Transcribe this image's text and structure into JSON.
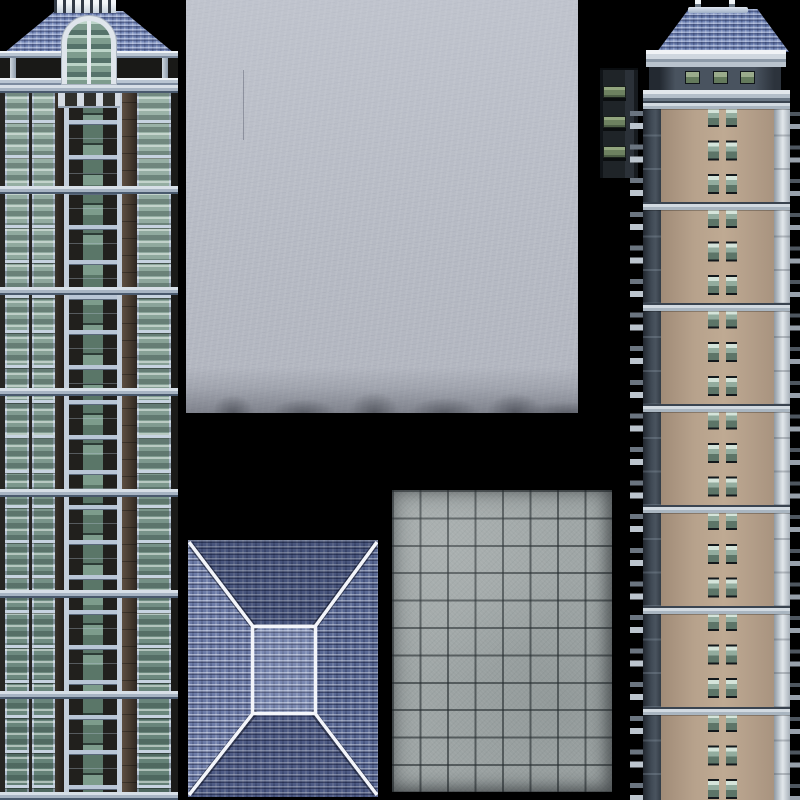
{
  "atlas": {
    "title": "Residential building texture atlas",
    "image_type": "3d-building-texture-atlas",
    "background_color": "#000000",
    "sprites": [
      {
        "id": "left-tower-facade",
        "label": "Residential glass-balcony tower facade (left column)",
        "bbox": "0,0 178x800",
        "features": {
          "crown_balustrade": true,
          "hip_roof": true,
          "arched_window": true,
          "pergola_beams": 2,
          "glass_columns": 4,
          "balcony_floors": 20,
          "major_floor_bands": 6
        },
        "palette": {
          "facade_dark": "#272624",
          "frame_light": "#b3c1d2",
          "glass_green": "#7d998d",
          "roof_blue": "#7487b6",
          "band_light": "#d7dfe7",
          "wood_brown": "#43382e"
        }
      },
      {
        "id": "stucco-wall-texture",
        "label": "Weathered stucco / concrete wall texture",
        "bbox": "186,0 392x413",
        "features": {
          "grime_bottom_edge": true,
          "hairline_cracks": 1
        },
        "palette": {
          "base": "#b9bdc6",
          "highlight": "#cbcfd9",
          "grime": "#4b4e58"
        }
      },
      {
        "id": "window-strip",
        "label": "Dark service core strip with 3 green window bars",
        "bbox": "600,68 38x110",
        "features": {
          "window_count": 3
        },
        "palette": {
          "panel_dark": "#1f2428",
          "panel_edge": "#2b3138",
          "glass_green": "#6d8160"
        }
      },
      {
        "id": "right-tower-facade",
        "label": "Tan high-rise facade with hip roof (right column)",
        "bbox": "630,0 170x800",
        "features": {
          "finials": 2,
          "hip_roof": true,
          "penthouse_windows": 3,
          "window_rows": 21,
          "windows_per_row": 2,
          "major_floor_bands": 6,
          "side_bracket_tabs": true
        },
        "palette": {
          "facade_tan": "#b7a28c",
          "facade_shadow": "#7e6e60",
          "roof_blue": "#6d81b2",
          "cornice_light": "#e3e8ed",
          "edge_dark": "#3f4954",
          "edge_light": "#cdd4da",
          "glass_green": "#93ac9e"
        }
      },
      {
        "id": "hip-roof-top-view",
        "label": "Blue shingle hip roof seen from above with white ridge lines",
        "bbox": "188,540 190x257",
        "features": {
          "ridge_lines": 4,
          "flat_top_rect": "253,627 62x86",
          "shingle_pattern": true
        },
        "palette": {
          "shingle_blue": "#5f6f9e",
          "shingle_dark": "#3d4a72",
          "ridge_white": "#f3f5fa",
          "top_rect_light": "#93a3c8"
        }
      },
      {
        "id": "concrete-tile-floor",
        "label": "Square concrete paving tile grid texture",
        "bbox": "392,490 220x302",
        "features": {
          "grid_columns": 8,
          "grid_rows": 11,
          "tile_size_px": 27
        },
        "palette": {
          "tile_gray": "#9fa6a6",
          "grout_dark": "#2e3639",
          "highlight": "#b7bdbd"
        }
      }
    ]
  }
}
